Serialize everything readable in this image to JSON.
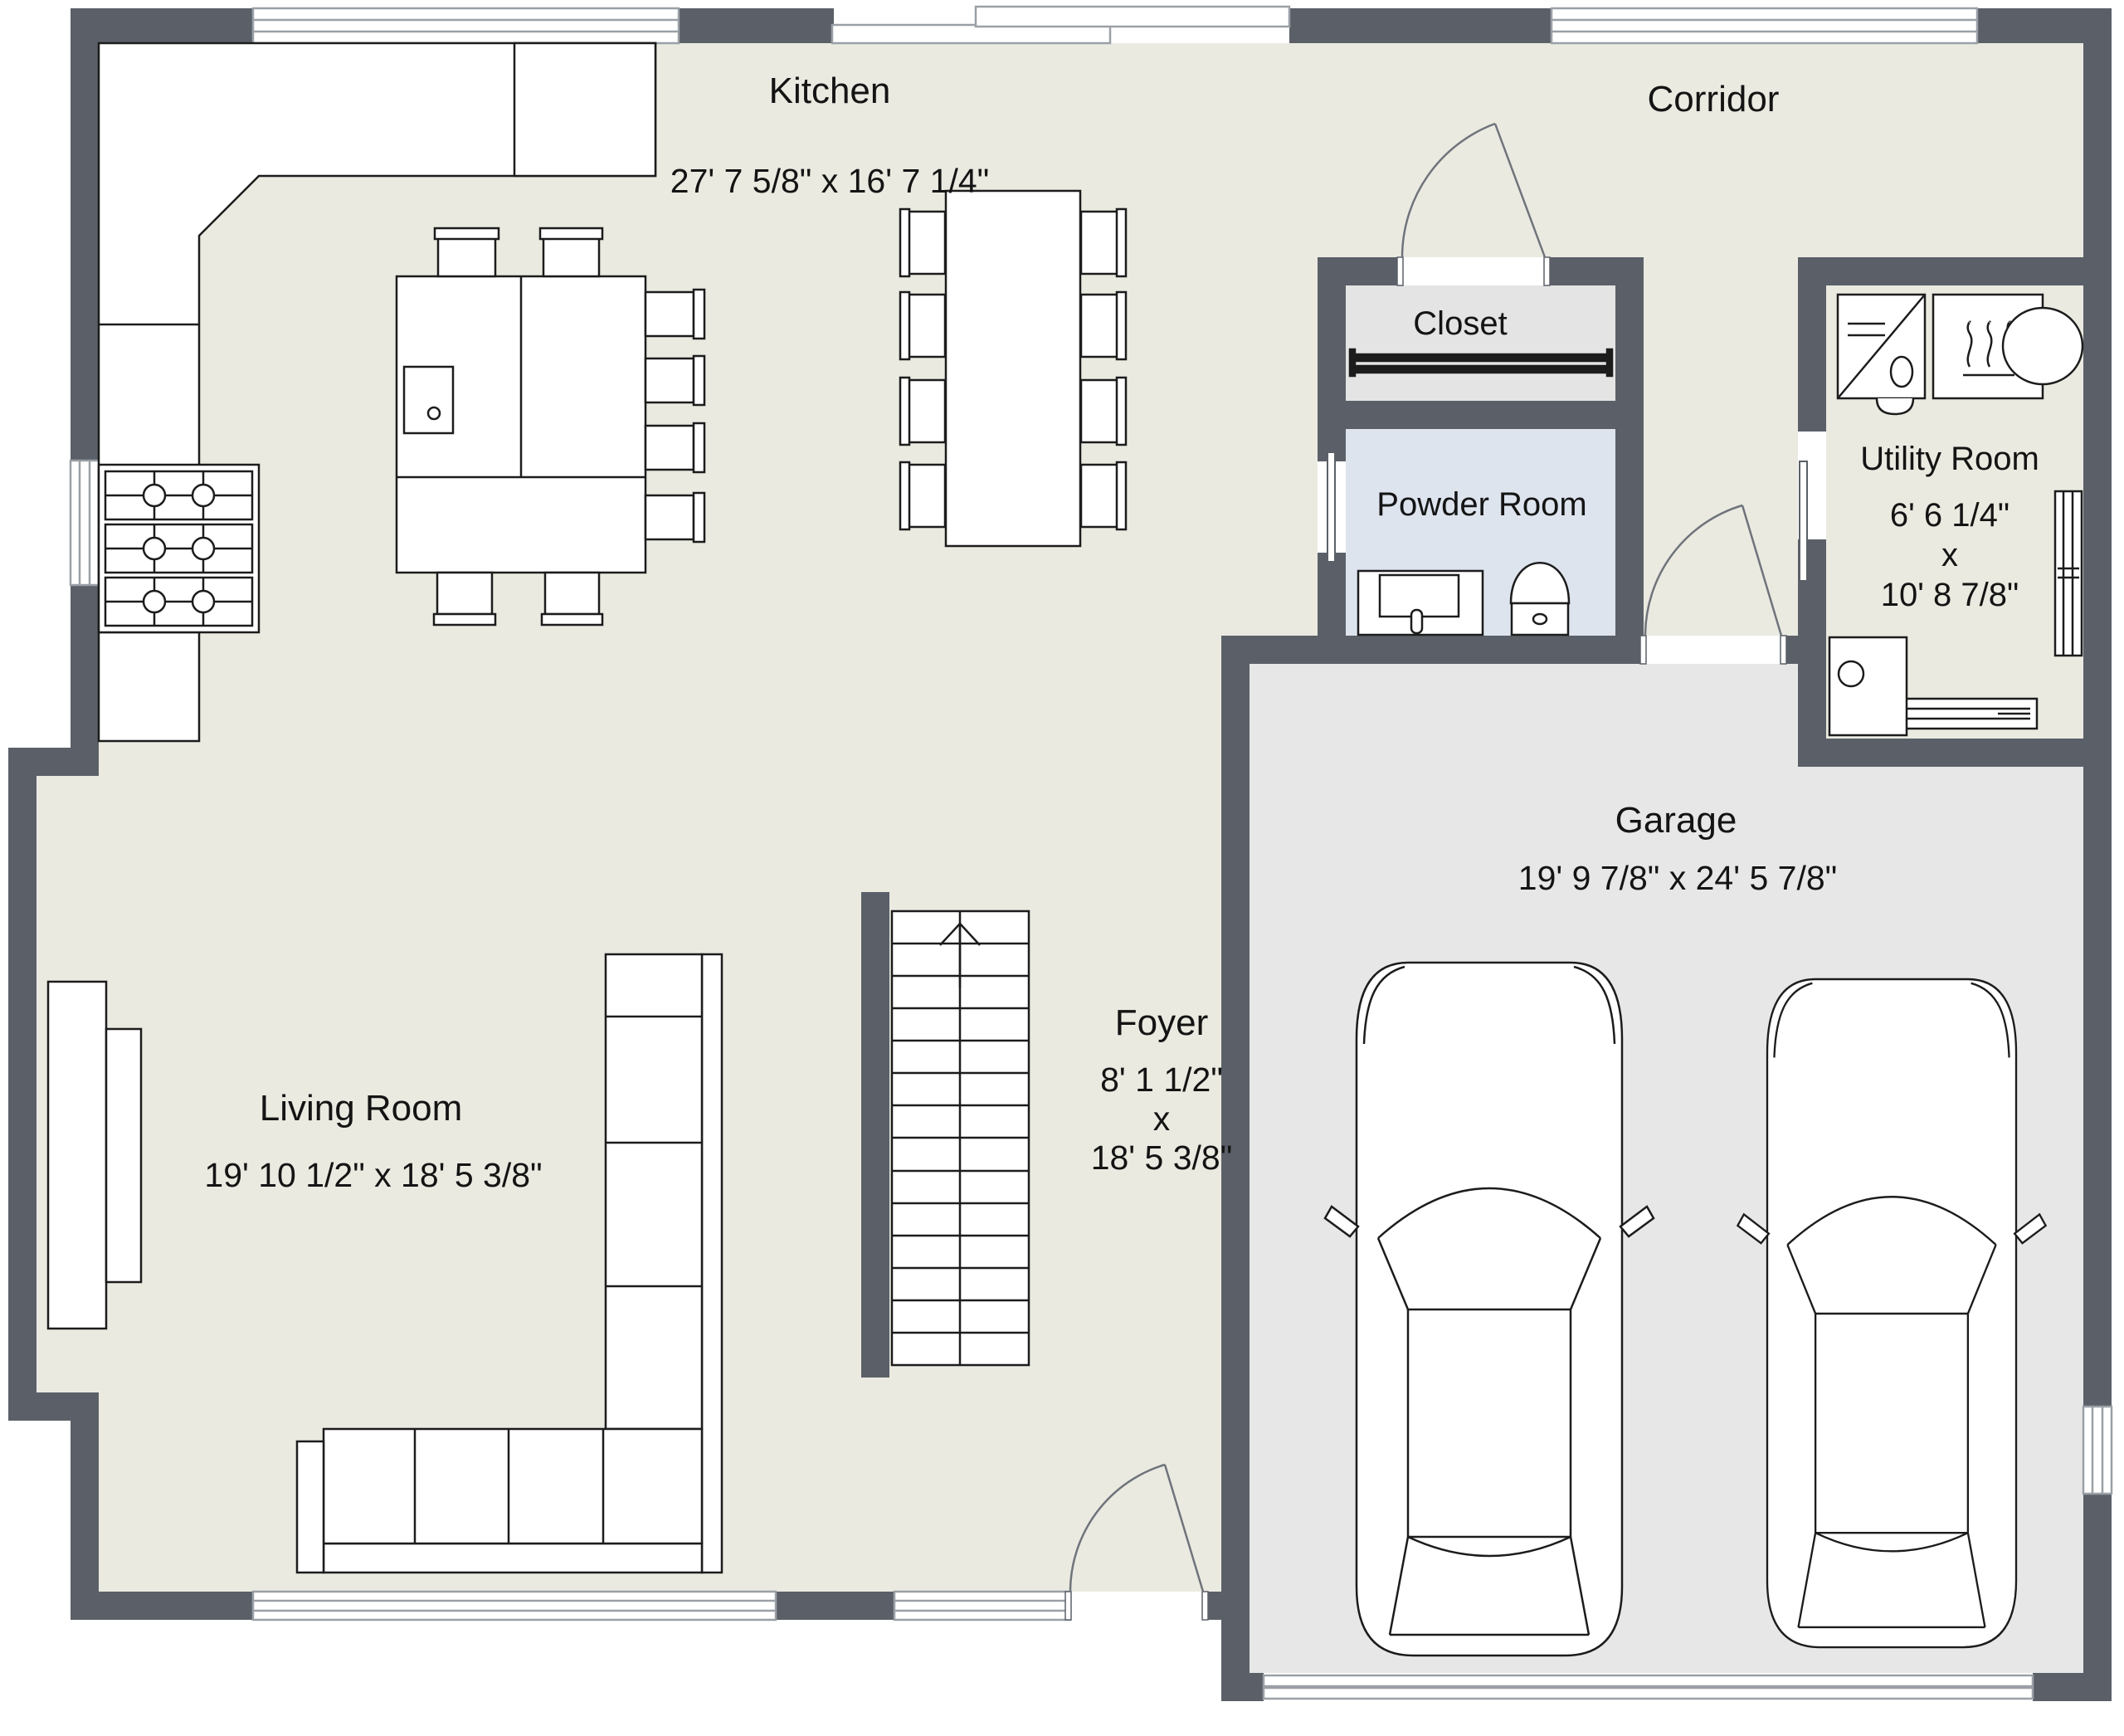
{
  "title": "First floor plan",
  "rooms": {
    "kitchen": {
      "label": "Kitchen",
      "dims": "27' 7 5/8\" x 16' 7 1/4\""
    },
    "corridor": {
      "label": "Corridor"
    },
    "closet": {
      "label": "Closet"
    },
    "powder": {
      "label": "Powder Room"
    },
    "utility": {
      "label": "Utility Room",
      "width": "6' 6 1/4\"",
      "sep": "x",
      "length": "10' 8 7/8\""
    },
    "garage": {
      "label": "Garage",
      "dims": "19' 9 7/8\" x 24' 5 7/8\""
    },
    "living": {
      "label": "Living Room",
      "dims": "19' 10 1/2\" x 18' 5 3/8\""
    },
    "foyer": {
      "label": "Foyer",
      "width": "8' 1 1/2\"",
      "sep": "x",
      "length": "18' 5 3/8\""
    }
  },
  "colors": {
    "wall": "#5b6068",
    "floor_main": "#eaeae1",
    "floor_garage": "#e7e7e8",
    "floor_closet": "#e4e4e4",
    "floor_powder": "#dde4ee",
    "outline": "#1c1c1c",
    "text": "#141414",
    "door_swing": "#6f747b",
    "window_frame": "#9aa0a6"
  },
  "fixtures": [
    "kitchen-counter",
    "fridge",
    "stove",
    "kitchen-island",
    "island-sink",
    "bar-stool",
    "dining-table",
    "dining-chair",
    "sofa",
    "console-table",
    "stairs-up-arrow",
    "closet-rod",
    "vanity-sink",
    "toilet",
    "washing-machine",
    "dryer",
    "utility-basin",
    "radiator",
    "baseboard-heater",
    "water-heater",
    "car",
    "garage-door",
    "window",
    "door-swing"
  ]
}
